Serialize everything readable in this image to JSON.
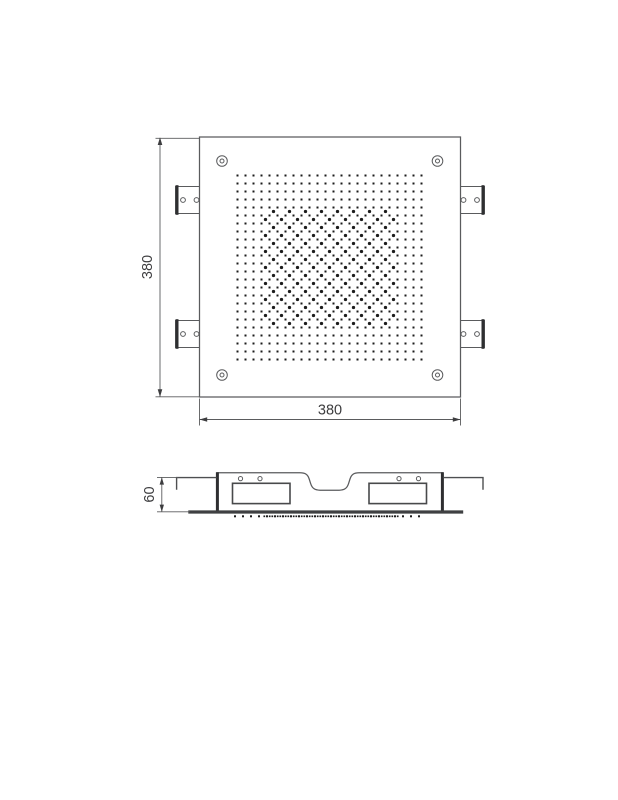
{
  "dims": {
    "top_height": "380",
    "top_width": "380",
    "side_height": "60"
  },
  "colors": {
    "background": "#ffffff",
    "line": "#5a5b5d",
    "thick_line": "#2e2f31",
    "dot": "#1c1c1c",
    "text": "#3d3d3f"
  },
  "nozzle_grid": {
    "cols": 24,
    "rows": 24,
    "spacing": 8,
    "origin_x": 237.5,
    "origin_y": 175.5,
    "dot_size": 2,
    "offset_dot_radius": 1.65,
    "offset_cells": {
      "col_min": 3,
      "col_max": 19,
      "row_min": 4,
      "row_max": 18,
      "parity": 0
    }
  },
  "side_nozzles": {
    "y": 516.3,
    "x_start": 235,
    "x_end": 421,
    "spacing": 8,
    "dot_size": 2,
    "triple_x_min": 267,
    "triple_x_max": 395,
    "triple_offset": 2.7,
    "triple_dot_size": 1.7
  }
}
